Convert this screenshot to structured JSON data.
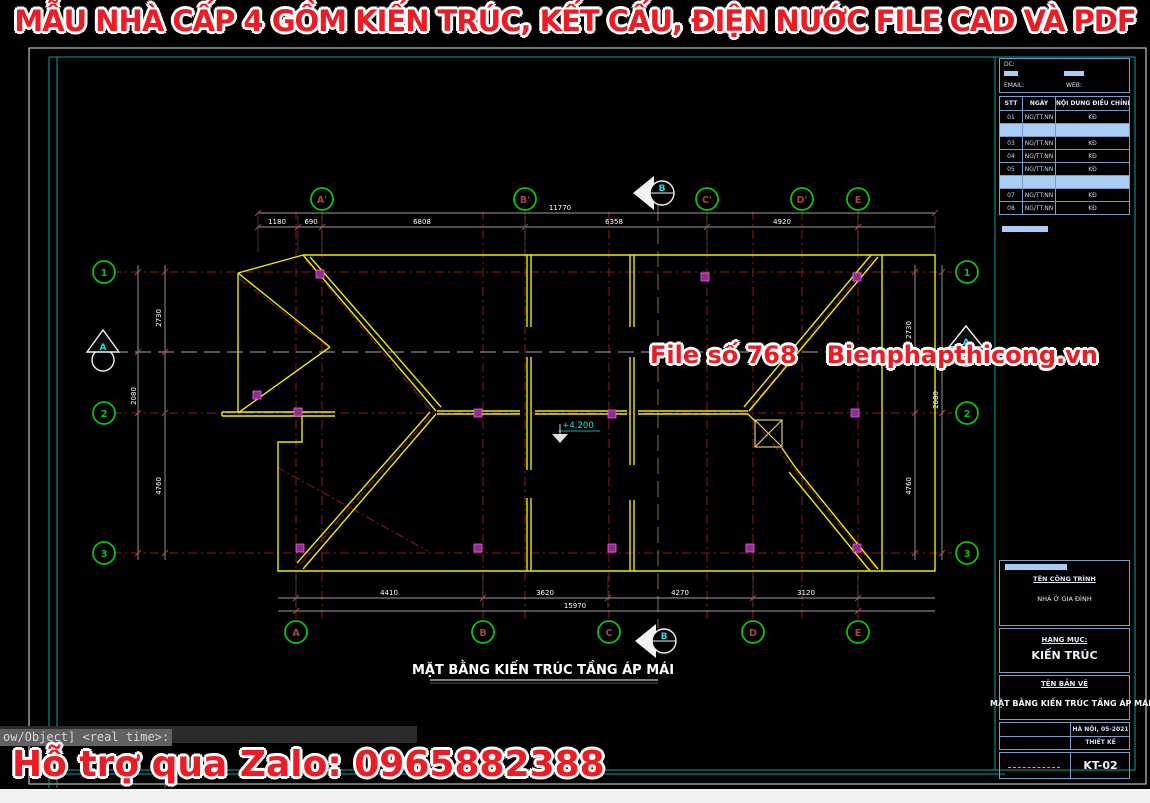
{
  "banner": {
    "text": "MẪU NHÀ CẤP 4 GỒM KIẾN TRÚC, KẾT CẤU, ĐIỆN NƯỚC FILE CAD VÀ PDF"
  },
  "watermark": {
    "file_label": "File số 768",
    "site": "Bienphapthicong.vn"
  },
  "support": {
    "text": "Hỗ trợ qua Zalo: 0965882388"
  },
  "command_line": {
    "text": "ow/Object] <real time>:"
  },
  "drawing": {
    "title": "MẶT BẰNG KIẾN TRÚC TẦNG ÁP MÁI",
    "level_label": "+4.200",
    "grid_letters_top": [
      "A'",
      "B'",
      "C'",
      "D'",
      "E"
    ],
    "grid_letters_bottom": [
      "A",
      "B",
      "C",
      "D",
      "E"
    ],
    "grid_numbers": [
      "1",
      "2",
      "3"
    ],
    "section_marker_horizontal": "A",
    "section_marker_vertical": "B",
    "dimensions": {
      "top_overall": "11770",
      "top_segments": [
        "1180",
        "690",
        "6808",
        "6358",
        "4920"
      ],
      "bottom_segments": [
        "4410",
        "3620",
        "4270",
        "3120"
      ],
      "bottom_overall": "15970",
      "left_segments": [
        "2730",
        "2080",
        "4760"
      ],
      "right_segments": [
        "2730",
        "2080",
        "4760"
      ]
    }
  },
  "title_block": {
    "contact": {
      "dc_label": "DC:",
      "email_label": "EMAIL:",
      "web_label": "WEB:"
    },
    "revision_table": {
      "headers": [
        "STT",
        "NGÀY",
        "NỘI DUNG ĐIỀU CHỈNH"
      ],
      "rows": [
        [
          "01",
          "NG/TT.NN",
          "KĐ"
        ],
        [
          "02",
          "NG/TT.NN",
          "KĐ"
        ],
        [
          "03",
          "NG/TT.NN",
          "KĐ"
        ],
        [
          "04",
          "NG/TT.NN",
          "KĐ"
        ],
        [
          "05",
          "NG/TT.NN",
          "KĐ"
        ],
        [
          "06",
          "NG/TT.NN",
          "KĐ"
        ],
        [
          "07",
          "NG/TT.NN",
          "KĐ"
        ],
        [
          "08",
          "NG/TT.NN",
          "KĐ"
        ]
      ]
    },
    "project_label": "TÊN CÔNG TRÌNH",
    "project_name": "NHÀ Ở GIA ĐÌNH",
    "category_label": "HẠNG MỤC:",
    "category_value": "KIẾN TRÚC",
    "sheet_label": "TÊN BẢN VẼ",
    "sheet_name": "MẶT BẰNG KIẾN TRÚC TẦNG ÁP MÁI",
    "place_date": "HÀ NỘI, 05-2021",
    "stage": "THIẾT KẾ",
    "sheet_number": "KT-02"
  },
  "colors": {
    "accent_red": "#ed1c24",
    "cad_yellow": "#ecec00",
    "grid_red": "#8b1a12",
    "bubble_green": "#0ac30a",
    "cyan": "#1ee0e0",
    "teal_border": "#0fa0a0",
    "highlight_blue": "#a9cdf4"
  }
}
